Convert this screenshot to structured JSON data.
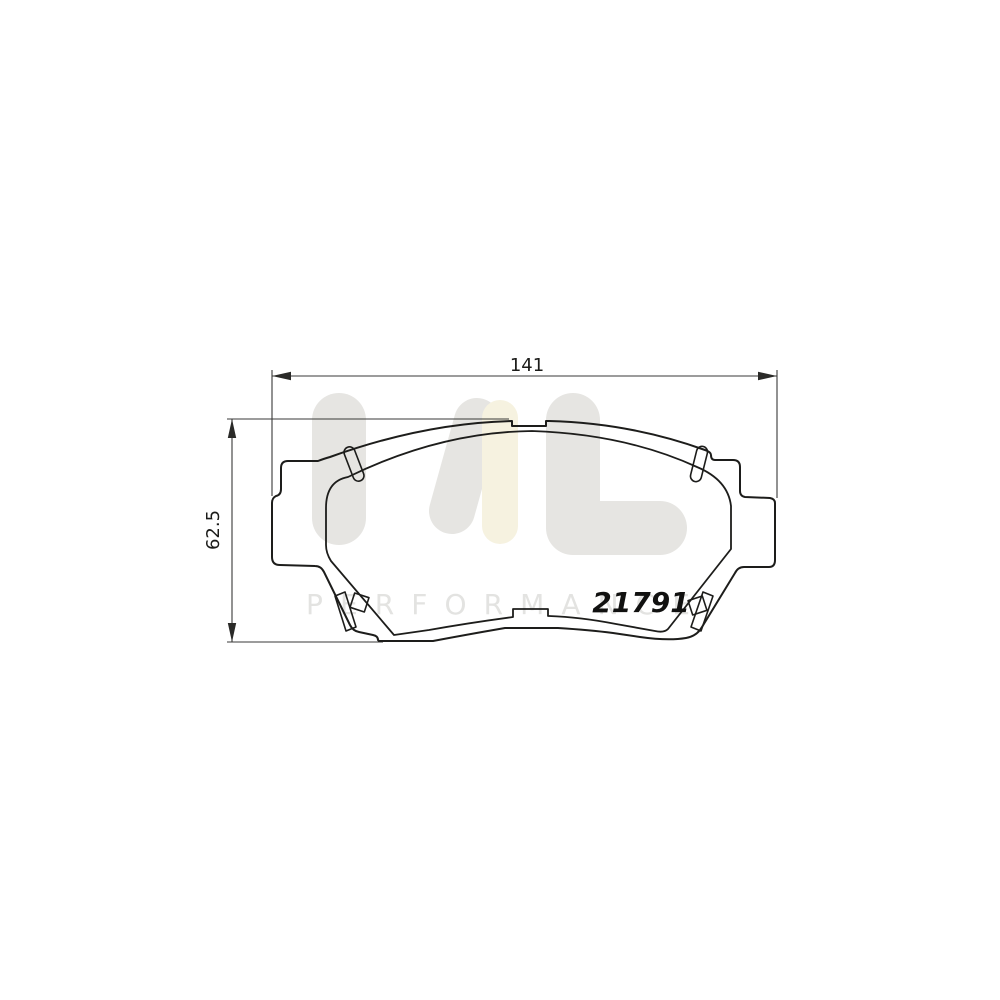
{
  "page": {
    "description": "Technical line drawing of a disc brake pad set with dimension annotations and brand watermark",
    "background": "#ffffff"
  },
  "drawing": {
    "part_number": "21791",
    "width_dimension_label": "141",
    "height_dimension_label": "62.5"
  },
  "watermark": {
    "letter_m": "M",
    "letter_l": "L",
    "wordmark": "PERFORMANCE",
    "gray": "#e6e5e2",
    "yellow": "#f6f2e0",
    "word_gray": "#e3e3e1"
  },
  "colors": {
    "outline": "#1d1d1b",
    "dimension_lines": "#3a3a38",
    "label_text": "#1c1c1a",
    "background": "#ffffff"
  }
}
